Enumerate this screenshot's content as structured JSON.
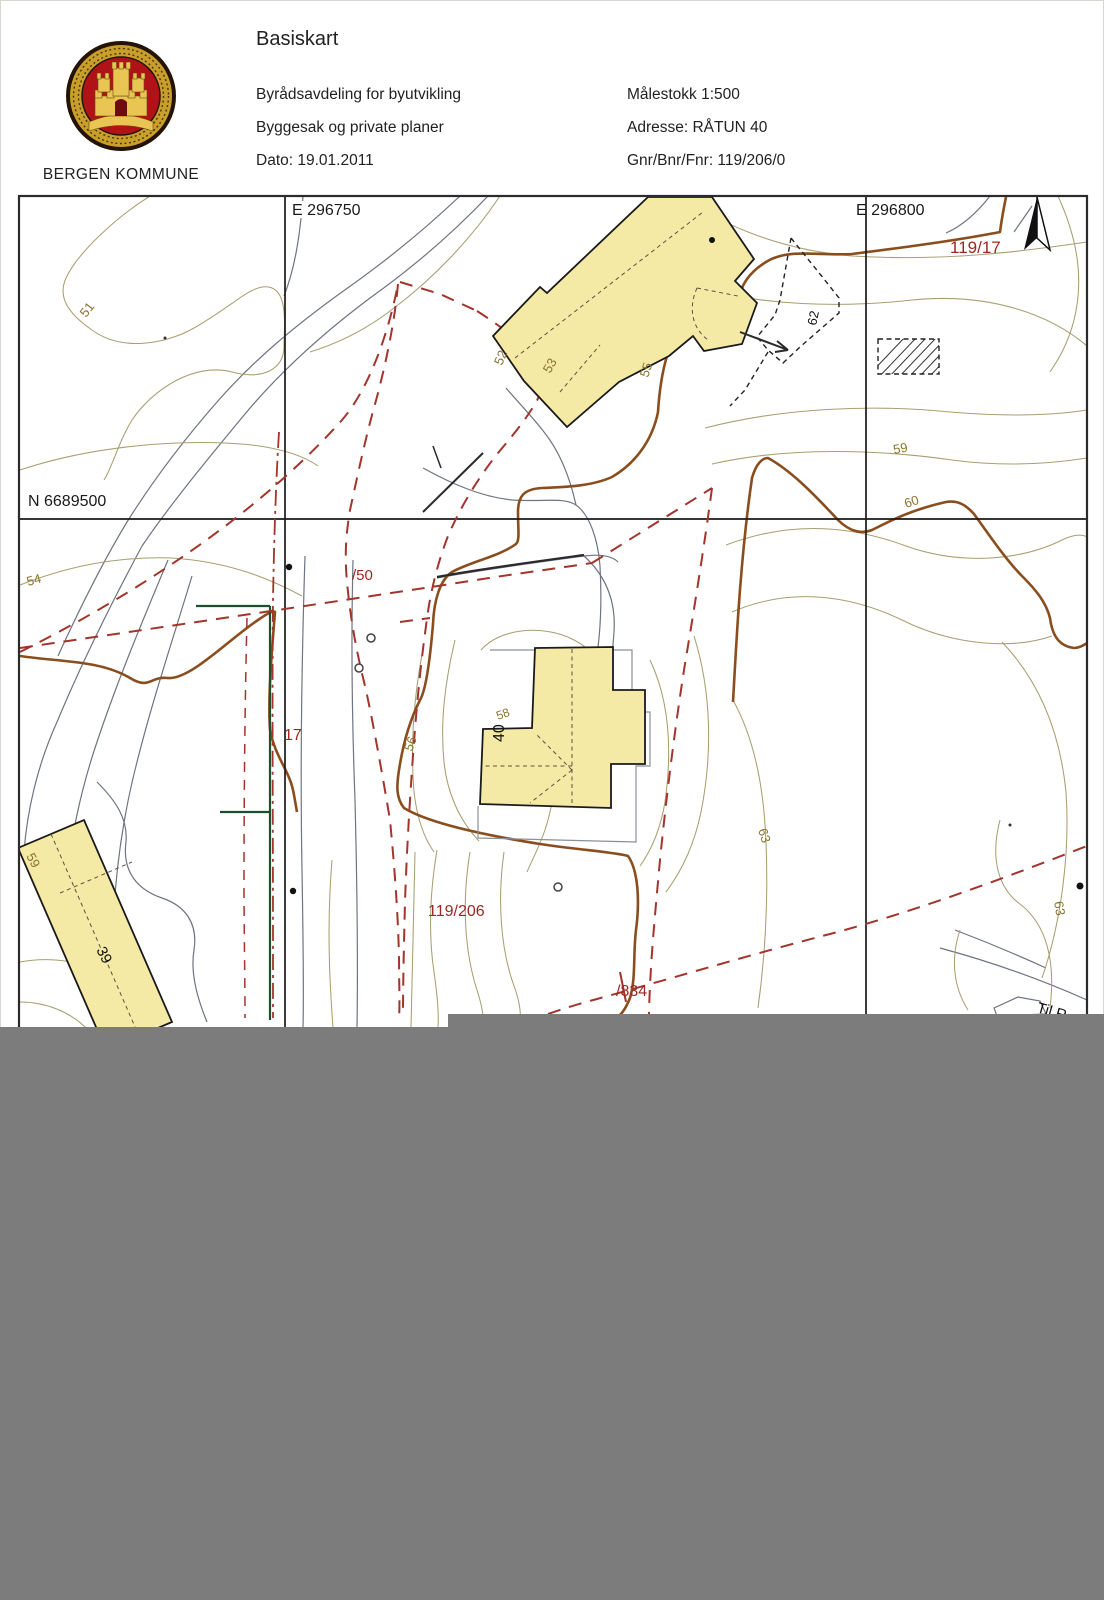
{
  "header": {
    "title": "Basiskart",
    "department": "Byrådsavdeling for byutvikling",
    "section": "Byggesak og private planer",
    "date": "Dato: 19.01.2011",
    "scale": "Målestokk 1:500",
    "address": "Adresse: RÅTUN 40",
    "parcel": "Gnr/Bnr/Fnr: 119/206/0",
    "municipality": "BERGEN KOMMUNE"
  },
  "map": {
    "grid": {
      "east1": "E 296750",
      "east2": "E 296800",
      "north1": "N 6689500"
    },
    "labels": {
      "parcel_119_17": "119/17",
      "parcel_119_206": "119/206",
      "parcel_834": "/834",
      "house_50": "/50",
      "house_17": "17",
      "house_40": "40",
      "house_39": "39",
      "feature_62": "62",
      "road_partial": "Til R",
      "contours": {
        "c51": "51",
        "c52": "52",
        "c53": "53",
        "c54": "54",
        "c55": "55",
        "c56": "56",
        "c58": "58",
        "c59a": "59",
        "c59b": "59",
        "c60": "60",
        "c63a": "63",
        "c63b": "63"
      }
    },
    "colors": {
      "building_fill": "#f5e9a6",
      "contour_line": "#a89f72",
      "contour_label": "#8a7430",
      "boundary_red": "#a3342c",
      "parcel_label_red": "#9c2722",
      "steep_brown": "#8a4e1e",
      "road_gray": "#6e7480",
      "fence_green": "#1e4f2d",
      "grid_black": "#1a1a1a",
      "redaction_gray": "#7c7c7c"
    },
    "symbols": {
      "north_arrow": "north-arrow",
      "hatched_area": "hatched-rectangle"
    }
  }
}
